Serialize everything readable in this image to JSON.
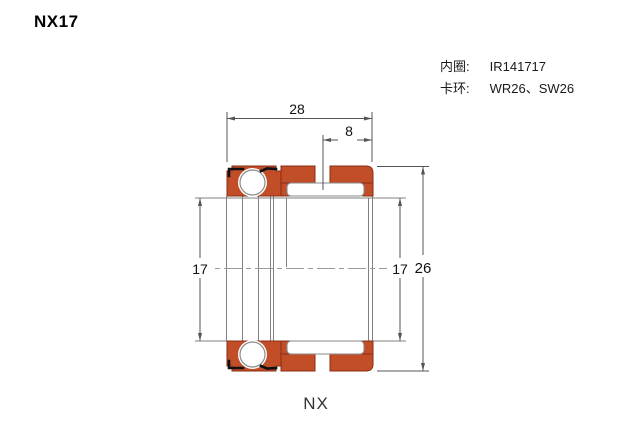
{
  "page": {
    "title": "NX17"
  },
  "specs": {
    "rows": [
      {
        "label": "内圈:",
        "value": "IR141717"
      },
      {
        "label": "卡环:",
        "value": "WR26、SW26"
      }
    ]
  },
  "drawing": {
    "part_label": "NX",
    "dimensions": {
      "overall_width": "28",
      "groove_offset": "8",
      "bore_left": "17",
      "bore_right": "17",
      "outer_diameter": "26"
    },
    "colors": {
      "ring_fill": "#c24e28",
      "ring_stroke": "#8a2c16",
      "line_gray": "#808080",
      "snap_ring_black": "#111111",
      "dim_color": "#555555"
    }
  }
}
